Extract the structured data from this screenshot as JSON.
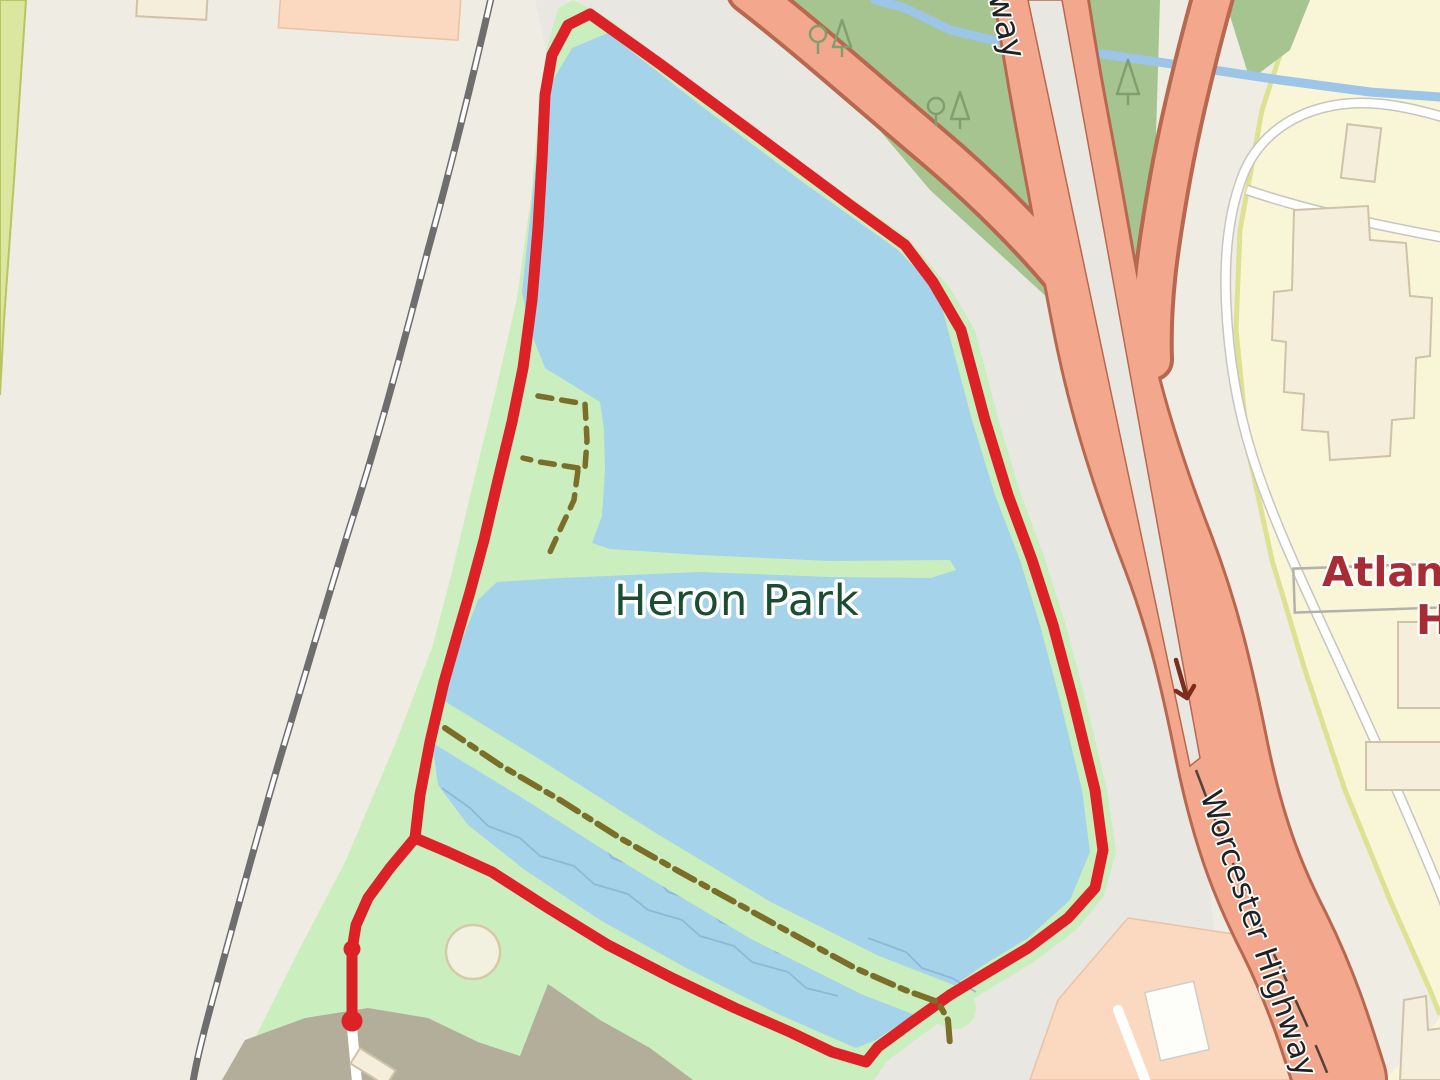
{
  "map": {
    "kind": "street-map-with-gps-track",
    "labels": {
      "park": "Heron Park",
      "highway": "Worcester Highway",
      "road_partial": "way",
      "poi_line1": "Atlantic",
      "poi_line2": "H"
    },
    "route": {
      "color": "#dc2127",
      "shape": "closed loop around Heron Park lake with spur tail to start marker",
      "markers": [
        "route-start-dot",
        "route-waypoint-dot"
      ]
    },
    "icons": [
      "deciduous-tree-icon",
      "conifer-tree-icon",
      "oneway-arrow-icon"
    ],
    "palette": {
      "base": "#efece4",
      "corridor": "#e9e7e1",
      "park_green": "#cbeebe",
      "forest": "#a5c490",
      "water": "#a5d3ea",
      "water_line": "#8db9d8",
      "stream": "#9cc5e8",
      "olive": "#b2ae9a",
      "railway": "#6e6e6e",
      "route_red": "#dc2127",
      "trail": "#7b6e28",
      "road_fill": "#f3a88d",
      "road_casing": "#b8684e",
      "road_divider_line": "#53423a",
      "hospital_yellow": "#f9f6d8",
      "hospital_edge": "#dde292",
      "retail_peach": "#fbd8c0",
      "building_cream": "#f4eedb",
      "building_stroke": "#cfc2a8",
      "label_park": "#1b4d33",
      "label_poi": "#a82c35",
      "label_road": "#212121",
      "clearing_fill": "#f2f1e0",
      "clearing_stroke": "#d8c9a6",
      "left_strip": "#dbe69f",
      "left_strip_edge": "#b9c55e",
      "tree": "#7fa06e",
      "arrow": "#7c2d1c"
    }
  }
}
